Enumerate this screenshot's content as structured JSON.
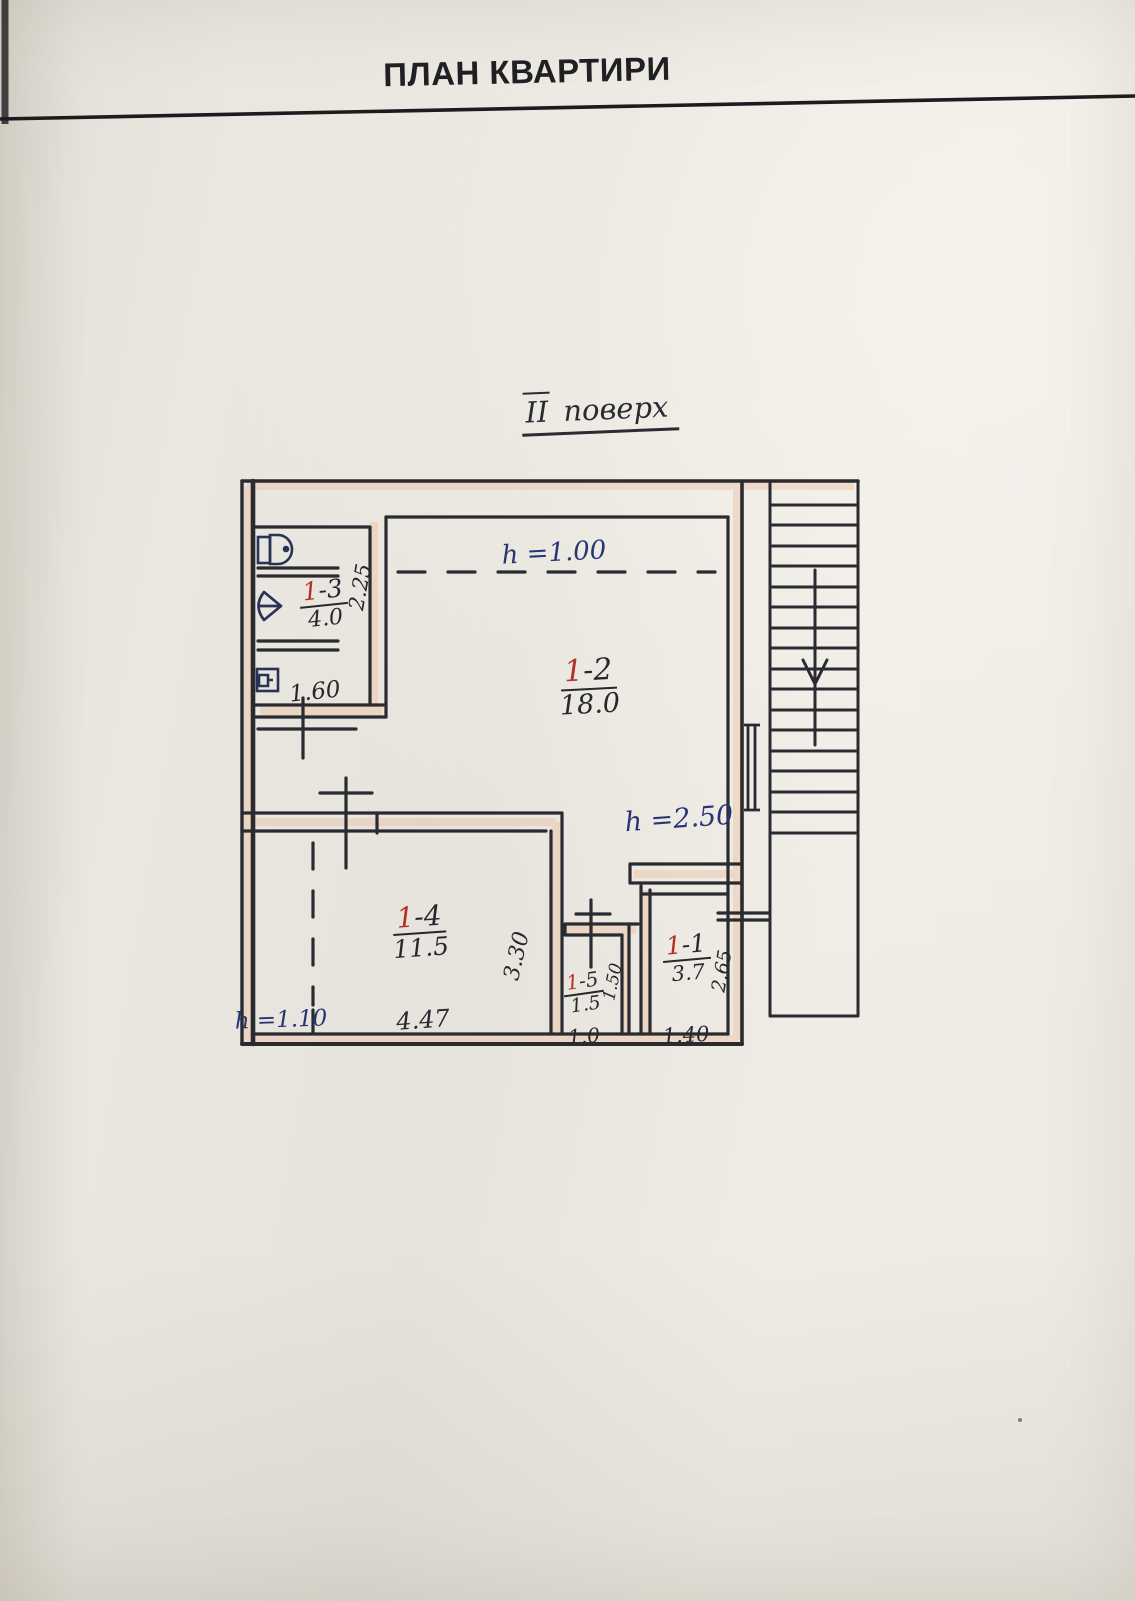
{
  "title": "ПЛАН КВАРТИРИ",
  "floor_label": {
    "numeral": "ІІ",
    "word": "поверх"
  },
  "rooms": [
    {
      "id": "1-3",
      "number_red": "1",
      "number_suffix": "-3",
      "area": "4.0"
    },
    {
      "id": "1-2",
      "number_red": "1",
      "number_suffix": "-2",
      "area": "18.0"
    },
    {
      "id": "1-4",
      "number_red": "1",
      "number_suffix": "-4",
      "area": "11.5"
    },
    {
      "id": "1-5",
      "number_red": "1",
      "number_suffix": "-5",
      "area": "1.5"
    },
    {
      "id": "1-1",
      "number_red": "1",
      "number_suffix": "-1",
      "area": "3.7"
    }
  ],
  "height_labels": {
    "upper_left": "h =1.00",
    "main": "h =2.50",
    "lower_left": "h =1.10"
  },
  "dimensions": {
    "bath_depth": "2.25",
    "bath_width": "1.60",
    "room_1_4_width": "4.47",
    "room_1_4_depth": "3.30",
    "room_1_5_width": "1.0",
    "room_1_5_depth": "1.50",
    "room_1_1_width": "1.40",
    "room_1_1_depth": "2.65"
  },
  "colors": {
    "paper": "#e9e6df",
    "ink": "#26282e",
    "ink_blue": "#273575",
    "ink_red": "#b23229",
    "wall_highlight": "#f0bd9d"
  },
  "icons": {
    "toilet": "toilet-icon",
    "sink": "sink-icon",
    "water_heater": "water-heater-icon",
    "stairs_down_arrow": "stairs-down-arrow-icon",
    "stair_window": "window-symbol-icon"
  }
}
